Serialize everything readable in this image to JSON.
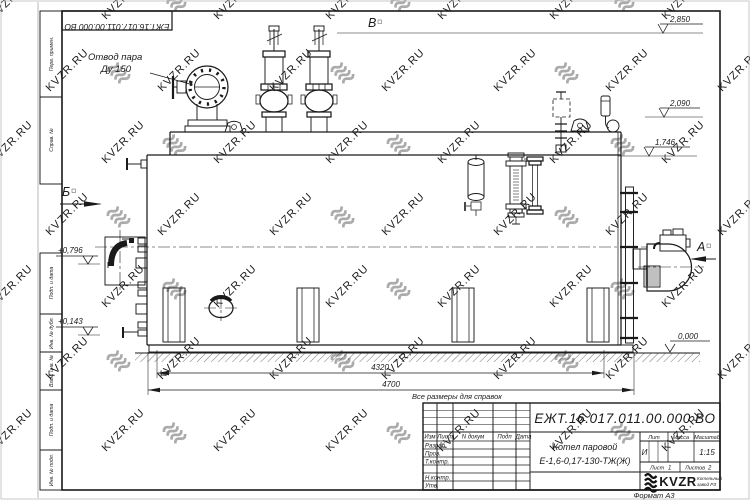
{
  "sheet": {
    "format_label": "Формат А3"
  },
  "document": {
    "doc_number": "ЕЖТ.16.017.011.00.000  ВО",
    "product_line1": "Котел паровой",
    "product_line2": "Е-1,6-0,17-130-ТЖ(Ж)",
    "reference_note": "Все размеры для справок"
  },
  "title_block": {
    "col_izm": "Изм",
    "col_list": "Лист",
    "col_ndokum": "N докум",
    "col_podp": "Подп",
    "col_data": "Дата",
    "row_razrab": "Разраб.",
    "row_prov": "Пров.",
    "row_tkontr": "Т.контр.",
    "row_nkontr": "Н.контр.",
    "row_utv": "Утв.",
    "lit_header": "Лит",
    "massa_header": "Масса",
    "masshtab_header": "Масштаб",
    "lit_value": "И",
    "masshtab_value": "1:15",
    "list_label": "Лист",
    "list_value": "1",
    "listov_label": "Листов",
    "listov_value": "2",
    "logo_text": "KVZR",
    "logo_sub_line1": "Котельный",
    "logo_sub_line2": "завод РЗ"
  },
  "margin_labels": [
    "Перв. примен.",
    "Справ. №",
    "Подп. и дата",
    "Инв. № дубл.",
    "Взам. инв. №",
    "Подп. и дата",
    "Инв. № подл."
  ],
  "annotations": {
    "steam_outlet_line1": "Отвод пара",
    "steam_outlet_line2": "Ду 150",
    "view_b": "Б",
    "view_v": "В",
    "view_a": "А"
  },
  "levels": {
    "top": "2,850",
    "gauge": "2,090",
    "shell_top": "1,746",
    "front_upper": "+0,796",
    "front_lower": "+0,143",
    "ground": "0,000"
  },
  "dimensions": {
    "length_shell": "4320",
    "length_total": "4700"
  },
  "watermark": {
    "text": "KVZR.RU",
    "text_color": "#c9c9c9",
    "logo_color": "#ababab"
  }
}
